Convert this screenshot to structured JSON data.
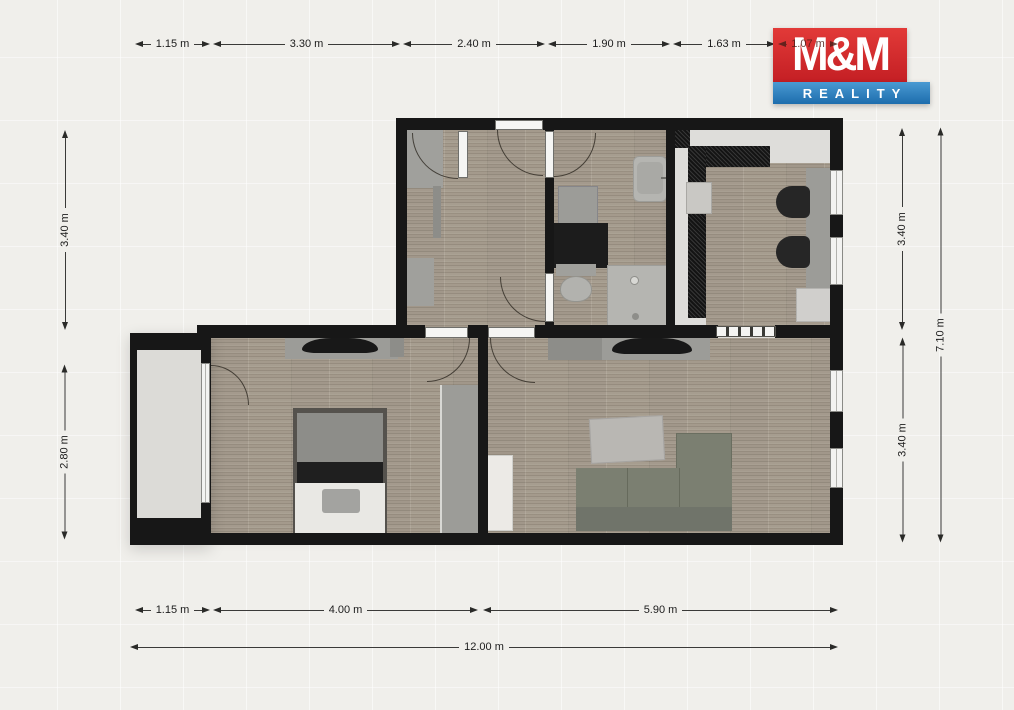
{
  "logo": {
    "name": "M&M",
    "tagline": "REALITY",
    "red": "#ce2127",
    "blue": "#2f82c2"
  },
  "dimensions": {
    "top": [
      "1.15 m",
      "3.30 m",
      "2.40 m",
      "1.90 m",
      "1.63 m",
      "1.07 m"
    ],
    "left": [
      "3.40 m",
      "2.80 m"
    ],
    "right_inner": [
      "3.40 m",
      "3.40 m"
    ],
    "right_outer": "7.10 m",
    "bottom": [
      "1.15 m",
      "4.00 m",
      "5.90 m"
    ],
    "bottom_total": "12.00 m"
  },
  "colors": {
    "wall": "#171717",
    "wood_floor": "#a49a8b",
    "balcony_floor": "#d7d6d2",
    "kitchen_counter": "#141414",
    "sofa": "#7b7f71",
    "background": "#f0efeb"
  }
}
